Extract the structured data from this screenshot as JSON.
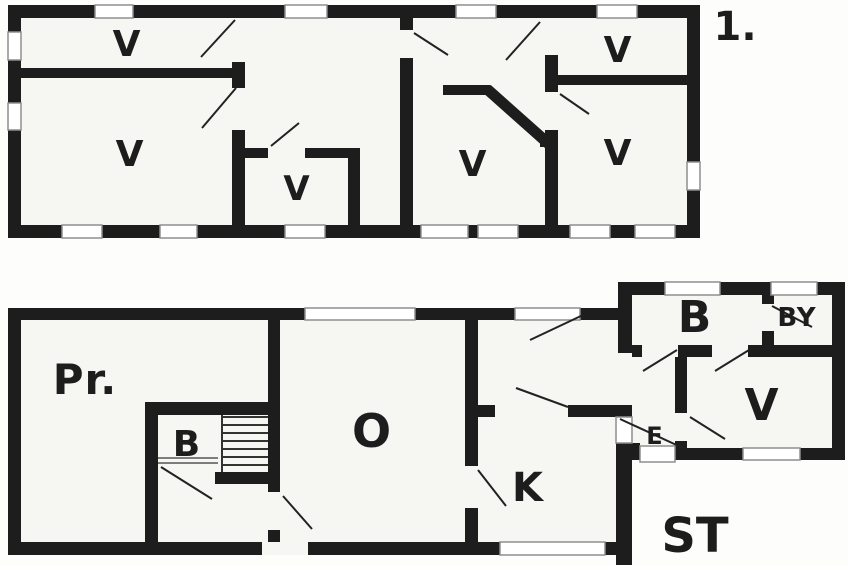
{
  "colors": {
    "wall": "#1d1d1d",
    "room_fill": "#f6f6f2",
    "window_outline": "#8f8f8f",
    "background": "#fdfdfb",
    "text": "#1d1d1d"
  },
  "upper_floor": {
    "floor_label": "1.",
    "rooms": {
      "v1": {
        "label": "V"
      },
      "v2": {
        "label": "V"
      },
      "v3": {
        "label": "V"
      },
      "v4": {
        "label": "V"
      },
      "v5": {
        "label": "V"
      },
      "v6": {
        "label": "V"
      }
    }
  },
  "lower_floor": {
    "rooms": {
      "pr": {
        "label": "Pr."
      },
      "b_small": {
        "label": "B"
      },
      "o": {
        "label": "O"
      },
      "k": {
        "label": "K"
      },
      "e": {
        "label": "E"
      },
      "b_bath": {
        "label": "B"
      },
      "by": {
        "label": "BY"
      },
      "v": {
        "label": "V"
      }
    },
    "outside_label": "ST"
  }
}
